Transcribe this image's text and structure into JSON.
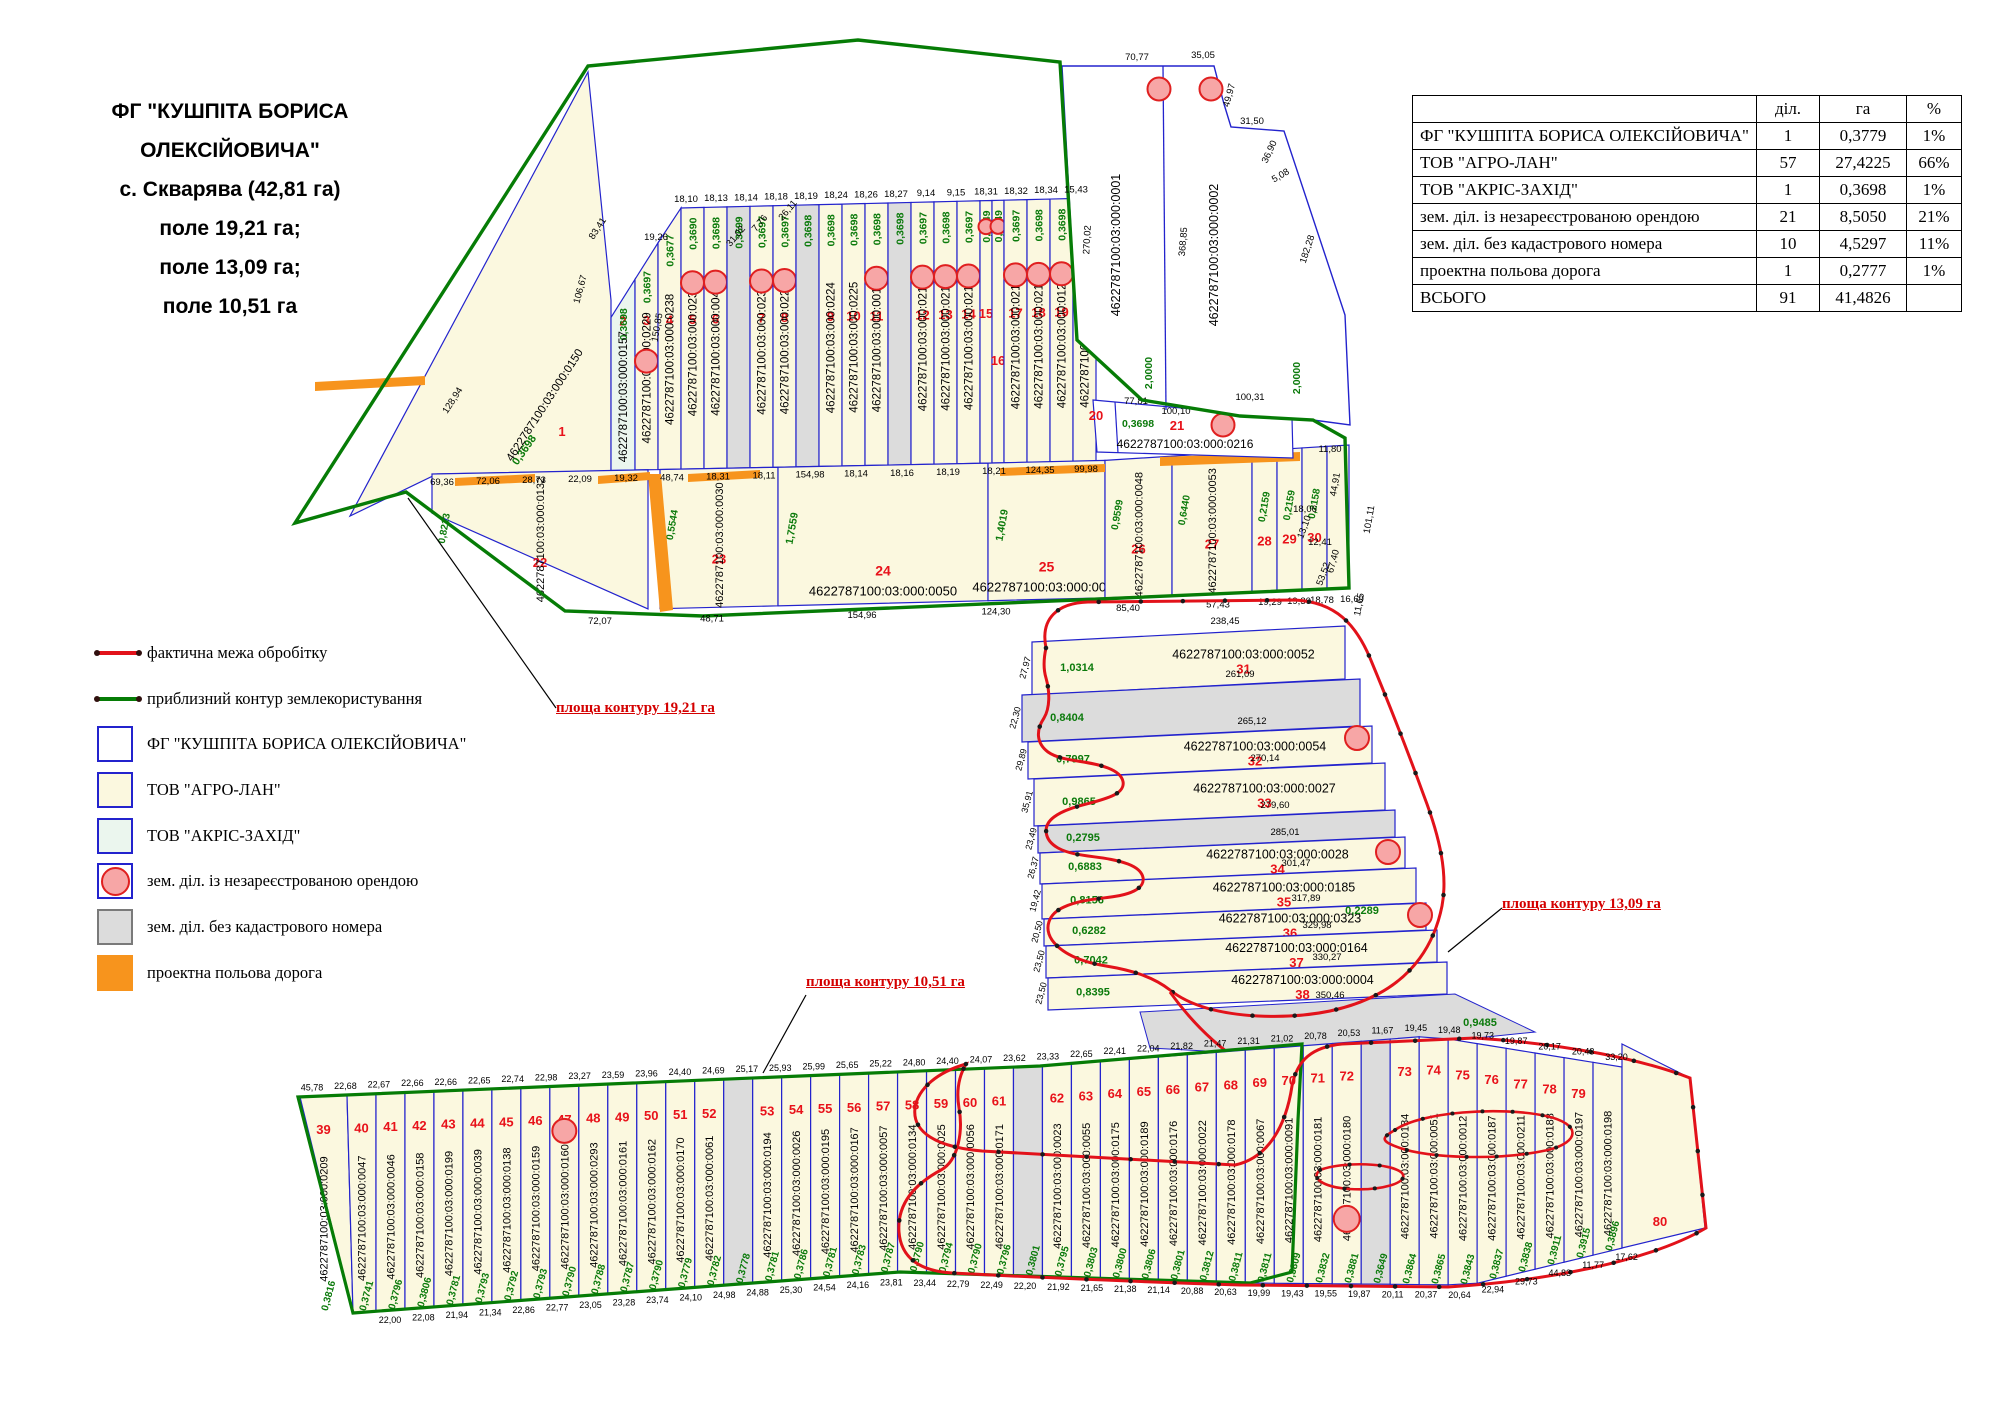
{
  "title": {
    "lines": [
      "ФГ \"КУШПІТА БОРИСА",
      "ОЛЕКСІЙОВИЧА\"",
      "с. Скварява (42,81 га)",
      "поле 19,21 га;",
      "поле 13,09 га;",
      "поле 10,51 га"
    ]
  },
  "table": {
    "headers": [
      "",
      "діл.",
      "га",
      "%"
    ],
    "rows": [
      {
        "label": "ФГ \"КУШПІТА БОРИСА ОЛЕКСІЙОВИЧА\"",
        "dil": "1",
        "ha": "0,3779",
        "pct": "1%"
      },
      {
        "label": "ТОВ \"АГРО-ЛАН\"",
        "dil": "57",
        "ha": "27,4225",
        "pct": "66%"
      },
      {
        "label": "ТОВ \"АКРІС-ЗАХІД\"",
        "dil": "1",
        "ha": "0,3698",
        "pct": "1%"
      },
      {
        "label": "зем. діл. із незареєстрованою орендою",
        "dil": "21",
        "ha": "8,5050",
        "pct": "21%"
      },
      {
        "label": "зем. діл. без кадастрового номера",
        "dil": "10",
        "ha": "4,5297",
        "pct": "11%"
      },
      {
        "label": "проектна польова дорога",
        "dil": "1",
        "ha": "0,2777",
        "pct": "1%"
      },
      {
        "label": "ВСЬОГО",
        "dil": "91",
        "ha": "41,4826",
        "pct": ""
      }
    ]
  },
  "legend": {
    "items": [
      {
        "type": "line",
        "color": "#e2121a",
        "label": "фактична межа обробітку"
      },
      {
        "type": "line",
        "color": "#067c06",
        "label": "приблизний контур землекористування"
      },
      {
        "type": "box",
        "fill": "#ffffff",
        "border": "#2323cd",
        "label": "ФГ \"КУШПІТА БОРИСА ОЛЕКСІЙОВИЧА\""
      },
      {
        "type": "box",
        "fill": "#fbf8df",
        "border": "#2323cd",
        "label": "ТОВ \"АГРО-ЛАН\""
      },
      {
        "type": "box",
        "fill": "#ebf6ee",
        "border": "#2323cd",
        "label": "ТОВ \"АКРІС-ЗАХІД\""
      },
      {
        "type": "box-circle",
        "fill": "#ffffff",
        "border": "#2323cd",
        "circle": "#f7a6a6",
        "circleBorder": "#e02020",
        "label": "зем. діл. із незареєстрованою орендою"
      },
      {
        "type": "box",
        "fill": "#dcdcdc",
        "border": "#7a7a7a",
        "label": "зем. діл. без кадастрового номера"
      },
      {
        "type": "box",
        "fill": "#f7941d",
        "border": "#f7941d",
        "label": "проектна польова дорога"
      }
    ]
  },
  "contour_labels": [
    {
      "text": "площа контуру 19,21 га"
    },
    {
      "text": "площа контуру 13,09 га"
    },
    {
      "text": "площа контуру 10,51 га"
    }
  ],
  "colors": {
    "agro": "#fbf8df",
    "akris": "#ebf6ee",
    "nocad": "#dcdcdc",
    "road": "#f7941d",
    "blue": "#2323cd",
    "green": "#067c06",
    "red": "#e2121a",
    "numRed": "#e8121a",
    "areaGreen": "#0b7a0b",
    "circleFill": "#f7a6a6",
    "circleStroke": "#e02020"
  },
  "map": {
    "block": {
      "parcels": [
        {
          "cad": "4622787100:03:000:0001",
          "area": "2,0000"
        },
        {
          "cad": "4622787100:03:000:0002",
          "area": "2,0000"
        }
      ],
      "dims": [
        "70,77",
        "35,05",
        "49,97",
        "31,50",
        "36,90",
        "5,08",
        "182,28",
        "368,85",
        "270,02",
        "100,31",
        "77,81",
        "100,10",
        "11,80"
      ]
    },
    "field1": {
      "strips": [
        {
          "n": "1",
          "cad": "4622787100:03:000:0150",
          "area": "0,3698",
          "fill": "agro"
        },
        {
          "n": "2",
          "cad": "4622787100:03:000:0157",
          "area": "0,3698",
          "fill": "akris"
        },
        {
          "n": "3",
          "cad": "4622787100:03:000:0229",
          "area": "0,3697",
          "fill": "agro",
          "circle": "low"
        },
        {
          "n": "4",
          "cad": "4622787100:03:000:0238",
          "area": "0,3677",
          "fill": "agro"
        },
        {
          "n": "5",
          "cad": "4622787100:03:000:0233",
          "area": "0,3690",
          "fill": "agro",
          "circle": "top"
        },
        {
          "n": "6",
          "cad": "4622787100:03:000:0045",
          "area": "0,3698",
          "fill": "agro",
          "circle": "top"
        },
        {
          "n": "",
          "cad": "",
          "area": "0,3699",
          "fill": "nocad"
        },
        {
          "n": "7",
          "cad": "4622787100:03:000:0231",
          "area": "0,3697",
          "fill": "agro",
          "circle": "top"
        },
        {
          "n": "8",
          "cad": "4622787100:03:000:0222",
          "area": "0,3697",
          "fill": "agro",
          "circle": "top"
        },
        {
          "n": "",
          "cad": "",
          "area": "0,3698",
          "fill": "nocad"
        },
        {
          "n": "9",
          "cad": "4622787100:03:000:0224",
          "area": "0,3698",
          "fill": "agro"
        },
        {
          "n": "10",
          "cad": "4622787100:03:000:0225",
          "area": "0,3698",
          "fill": "agro"
        },
        {
          "n": "11",
          "cad": "4622787100:03:000:0013",
          "area": "0,3698",
          "fill": "agro",
          "circle": "top"
        },
        {
          "n": "",
          "cad": "",
          "area": "0,3698",
          "fill": "nocad"
        },
        {
          "n": "12",
          "cad": "4622787100:03:000:0217",
          "area": "0,3697",
          "fill": "agro",
          "circle": "top"
        },
        {
          "n": "13",
          "cad": "4622787100:03:000:0218",
          "area": "0,3698",
          "fill": "agro",
          "circle": "top"
        },
        {
          "n": "14",
          "cad": "4622787100:03:000:0219",
          "area": "0,3697",
          "fill": "agro",
          "circle": "top"
        },
        {
          "n": "15",
          "cad": "",
          "area": "0,1849",
          "fill": "agro",
          "circle": "small"
        },
        {
          "n": "16",
          "cad": "",
          "area": "0,1849",
          "fill": "agro",
          "circle": "small"
        },
        {
          "n": "17",
          "cad": "4622787100:03:000:0212",
          "area": "0,3697",
          "fill": "agro",
          "circle": "top"
        },
        {
          "n": "18",
          "cad": "4622787100:03:000:0213",
          "area": "0,3698",
          "fill": "agro",
          "circle": "top"
        },
        {
          "n": "19",
          "cad": "4622787100:03:000:0122",
          "area": "0,3698",
          "fill": "agro",
          "circle": "top"
        },
        {
          "n": "",
          "cad": "4622787100:03:000:0215",
          "area": "0,3698",
          "fill": "agro",
          "circle": "top"
        }
      ],
      "bottom": [
        {
          "n": "22",
          "cad": "4622787100:03:000:0132",
          "area": "0,8213"
        },
        {
          "n": "23",
          "cad": "4622787100:03:000:0030",
          "area": "0,5544"
        },
        {
          "n": "24",
          "cad": "4622787100:03:000:0050",
          "area": "1,7559",
          "wide": true
        },
        {
          "n": "25",
          "cad": "4622787100:03:000:0049",
          "area": "1,4019",
          "wide": true
        },
        {
          "n": "26",
          "cad": "4622787100:03:000:0048",
          "area": "0,9599"
        },
        {
          "n": "27",
          "cad": "4622787100:03:000:0053",
          "area": "0,6440"
        },
        {
          "n": "28",
          "cad": "",
          "area": "0,2159"
        },
        {
          "n": "29",
          "cad": "",
          "area": "0,2159"
        },
        {
          "n": "30",
          "cad": "",
          "area": "0,2158"
        }
      ],
      "row2021": {
        "n20": "20",
        "n21": "21",
        "cad": "4622787100:03:000:0216",
        "area": "0,3698"
      },
      "dims_top": [
        "19,26",
        "18,10",
        "18,13",
        "18,14",
        "18,18",
        "18,19",
        "18,24",
        "18,26",
        "18,27",
        "9,14",
        "9,15",
        "18,31",
        "18,32",
        "18,34",
        "15,43"
      ],
      "dims_mid": [
        "69,36",
        "72,06",
        "28,73",
        "22,09",
        "19,32",
        "48,74",
        "18,31",
        "18,11",
        "154,98",
        "18,14",
        "18,16",
        "18,19",
        "18,21",
        "124,35",
        "99,98"
      ],
      "dims_bottom": [
        "72,07",
        "48,71",
        "154,96",
        "124,30",
        "85,40",
        "57,43",
        "19,29",
        "19,30",
        "18,78",
        "16,69"
      ],
      "dims_left": [
        "128,94",
        "106,67",
        "150,85",
        "83,41",
        "31,02",
        "7,76",
        "26,11"
      ],
      "dims_right": [
        "44,91",
        "18,06",
        "13,10",
        "12,41",
        "67,40",
        "53,52",
        "101,11",
        "11,65"
      ]
    },
    "field2": {
      "bands": [
        {
          "n": "31",
          "cad": "4622787100:03:000:0052",
          "area": "1,0314",
          "fill": "agro"
        },
        {
          "n": "",
          "cad": "",
          "area": "0,8404",
          "fill": "nocad"
        },
        {
          "n": "32",
          "cad": "4622787100:03:000:0054",
          "area": "0,7997",
          "fill": "agro",
          "circle": true
        },
        {
          "n": "33",
          "cad": "4622787100:03:000:0027",
          "area": "0,9865",
          "fill": "agro"
        },
        {
          "n": "",
          "cad": "",
          "area": "0,2795",
          "fill": "nocad"
        },
        {
          "n": "34",
          "cad": "4622787100:03:000:0028",
          "area": "0,6883",
          "fill": "agro",
          "circle": true
        },
        {
          "n": "35",
          "cad": "4622787100:03:000:0185",
          "area": "0,8156",
          "fill": "agro"
        },
        {
          "n": "36",
          "cad": "4622787100:03:000:0323",
          "area": "0,6282",
          "fill": "agro",
          "circle": true
        },
        {
          "n": "37",
          "cad": "4622787100:03:000:0164",
          "area": "0,7042",
          "fill": "agro"
        },
        {
          "n": "38",
          "cad": "4622787100:03:000:0004",
          "area": "0,8395",
          "fill": "agro"
        }
      ],
      "gray_bottom_area": "0,9485",
      "extra_area": "0,2289",
      "dims_left": [
        "27,97",
        "22,30",
        "29,89",
        "35,91",
        "23,49",
        "26,37",
        "19,42",
        "20,50",
        "23,50"
      ],
      "dims_right": [
        "238,45",
        "261,09",
        "265,12",
        "270,14",
        "279,60",
        "285,01",
        "301,47",
        "317,89",
        "329,98",
        "330,27",
        "350,46",
        "365,09"
      ]
    },
    "field3": {
      "strips": [
        {
          "n": "39",
          "cad": "4622787100:03:000:0209",
          "area": "0,3816",
          "fill": "agro"
        },
        {
          "n": "40",
          "cad": "4622787100:03:000:0047",
          "area": "0,3741",
          "fill": "agro"
        },
        {
          "n": "41",
          "cad": "4622787100:03:000:0046",
          "area": "0,3796",
          "fill": "agro"
        },
        {
          "n": "42",
          "cad": "4622787100:03:000:0158",
          "area": "0,3806",
          "fill": "agro"
        },
        {
          "n": "43",
          "cad": "4622787100:03:000:0199",
          "area": "0,3781",
          "fill": "agro"
        },
        {
          "n": "44",
          "cad": "4622787100:03:000:0039",
          "area": "0,3793",
          "fill": "agro"
        },
        {
          "n": "45",
          "cad": "4622787100:03:000:0138",
          "area": "0,3792",
          "fill": "agro"
        },
        {
          "n": "46",
          "cad": "4622787100:03:000:0159",
          "area": "0,3793",
          "fill": "agro"
        },
        {
          "n": "47",
          "cad": "4622787100:03:000:0160",
          "area": "0,3790",
          "fill": "agro",
          "circle": "top"
        },
        {
          "n": "48",
          "cad": "4622787100:03:000:0293",
          "area": "0,3788",
          "fill": "agro"
        },
        {
          "n": "49",
          "cad": "4622787100:03:000:0161",
          "area": "0,3787",
          "fill": "agro"
        },
        {
          "n": "50",
          "cad": "4622787100:03:000:0162",
          "area": "0,3790",
          "fill": "agro"
        },
        {
          "n": "51",
          "cad": "4622787100:03:000:0170",
          "area": "0,3779",
          "fill": "agro"
        },
        {
          "n": "52",
          "cad": "4622787100:03:000:0061",
          "area": "0,3782",
          "fill": "agro"
        },
        {
          "n": "",
          "cad": "",
          "area": "0,3778",
          "fill": "nocad"
        },
        {
          "n": "53",
          "cad": "4622787100:03:000:0194",
          "area": "0,3781",
          "fill": "agro"
        },
        {
          "n": "54",
          "cad": "4622787100:03:000:0026",
          "area": "0,3786",
          "fill": "agro"
        },
        {
          "n": "55",
          "cad": "4622787100:03:000:0195",
          "area": "0,3781",
          "fill": "agro"
        },
        {
          "n": "56",
          "cad": "4622787100:03:000:0167",
          "area": "0,3783",
          "fill": "agro"
        },
        {
          "n": "57",
          "cad": "4622787100:03:000:0057",
          "area": "0,3787",
          "fill": "agro"
        },
        {
          "n": "58",
          "cad": "4622787100:03:000:0134",
          "area": "0,3790",
          "fill": "agro"
        },
        {
          "n": "59",
          "cad": "4622787100:03:000:0025",
          "area": "0,3794",
          "fill": "agro"
        },
        {
          "n": "60",
          "cad": "4622787100:03:000:0056",
          "area": "0,3790",
          "fill": "agro"
        },
        {
          "n": "61",
          "cad": "4622787100:03:000:0171",
          "area": "0,3796",
          "fill": "agro"
        },
        {
          "n": "",
          "cad": "",
          "area": "0,3801",
          "fill": "nocad"
        },
        {
          "n": "62",
          "cad": "4622787100:03:000:0023",
          "area": "0,3795",
          "fill": "agro"
        },
        {
          "n": "63",
          "cad": "4622787100:03:000:0055",
          "area": "0,3803",
          "fill": "agro"
        },
        {
          "n": "64",
          "cad": "4622787100:03:000:0175",
          "area": "0,3800",
          "fill": "agro"
        },
        {
          "n": "65",
          "cad": "4622787100:03:000:0189",
          "area": "0,3806",
          "fill": "agro"
        },
        {
          "n": "66",
          "cad": "4622787100:03:000:0176",
          "area": "0,3801",
          "fill": "agro"
        },
        {
          "n": "67",
          "cad": "4622787100:03:000:0022",
          "area": "0,3812",
          "fill": "agro"
        },
        {
          "n": "68",
          "cad": "4622787100:03:000:0178",
          "area": "0,3811",
          "fill": "agro"
        },
        {
          "n": "69",
          "cad": "4622787100:03:000:0067",
          "area": "0,3811",
          "fill": "agro"
        },
        {
          "n": "70",
          "cad": "4622787100:03:000:0091",
          "area": "0,3809",
          "fill": "agro"
        },
        {
          "n": "71",
          "cad": "4622787100:03:000:0181",
          "area": "0,3832",
          "fill": "agro"
        },
        {
          "n": "72",
          "cad": "4622787100:03:000:0180",
          "area": "0,3881",
          "fill": "agro",
          "circle": "bottom"
        },
        {
          "n": "",
          "cad": "",
          "area": "0,3649",
          "fill": "nocad"
        },
        {
          "n": "73",
          "cad": "4622787100:03:000:0184",
          "area": "0,3864",
          "fill": "agro"
        },
        {
          "n": "74",
          "cad": "4622787100:03:000:0051",
          "area": "0,3865",
          "fill": "agro"
        },
        {
          "n": "75",
          "cad": "4622787100:03:000:0012",
          "area": "0,3843",
          "fill": "agro"
        },
        {
          "n": "76",
          "cad": "4622787100:03:000:0187",
          "area": "0,3837",
          "fill": "agro"
        },
        {
          "n": "77",
          "cad": "4622787100:03:000:0211",
          "area": "0,3838",
          "fill": "agro"
        },
        {
          "n": "78",
          "cad": "4622787100:03:000:0188",
          "area": "0,3911",
          "fill": "agro"
        },
        {
          "n": "79",
          "cad": "4622787100:03:000:0197",
          "area": "0,3915",
          "fill": "agro"
        },
        {
          "n": "",
          "cad": "4622787100:03:000:0198",
          "area": "0,3896",
          "fill": "agro"
        }
      ],
      "tip": {
        "n": "80"
      },
      "dims_top": [
        "45,78",
        "22,68",
        "22,67",
        "22,66",
        "22,66",
        "22,65",
        "22,74",
        "22,98",
        "23,27",
        "23,59",
        "23,96",
        "24,40",
        "24,69",
        "25,17",
        "25,93",
        "25,99",
        "25,65",
        "25,22",
        "24,80",
        "24,40",
        "24,07",
        "23,62",
        "23,33",
        "22,65",
        "22,41",
        "22,04",
        "21,82",
        "21,47",
        "21,31",
        "21,02",
        "20,78",
        "20,53",
        "11,67",
        "19,45",
        "19,48",
        "19,73",
        "19,87",
        "20,17",
        "20,43",
        "33,20"
      ],
      "dims_bottom": [
        "22,00",
        "22,08",
        "21,94",
        "21,34",
        "22,86",
        "22,77",
        "23,05",
        "23,28",
        "23,74",
        "24,10",
        "24,98",
        "24,88",
        "25,30",
        "24,54",
        "24,16",
        "23,81",
        "23,44",
        "22,79",
        "22,49",
        "22,20",
        "21,92",
        "21,65",
        "21,38",
        "21,14",
        "20,88",
        "20,63",
        "19,99",
        "19,43",
        "19,55",
        "19,87",
        "20,11",
        "20,37",
        "20,64",
        "22,94",
        "29,73",
        "44,83",
        "11,77",
        "17,62"
      ]
    }
  }
}
